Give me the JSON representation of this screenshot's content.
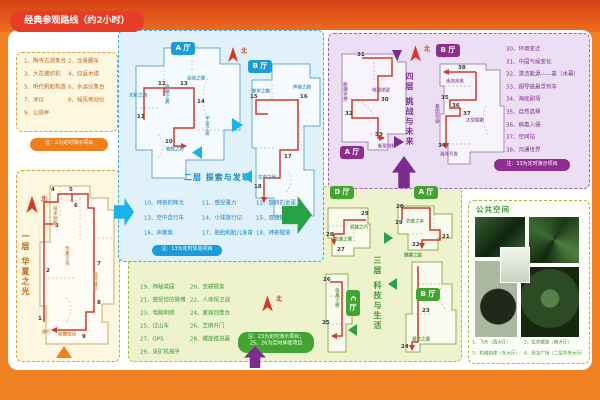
{
  "labels": {
    "north": "北"
  },
  "header": {
    "title": "经典参观路线（约2小时）"
  },
  "colors": {
    "orange": "#f08122",
    "red_route": "#d4382a",
    "floor1": "#c0661d",
    "floor2": "#1b9cd8",
    "floor3": "#43a531",
    "floor4": "#8e2d8e",
    "title_pill": "#e63c28"
  },
  "f1": {
    "floor_title": "一层  华夏之光",
    "list": [
      "1、陶寺古观象台",
      "3、大花楼织机",
      "5、明代帆船构造",
      "7、浑仪",
      "9、公道杯",
      "2、龙骨翻车",
      "4、应县木塔",
      "6、水运仪象台",
      "8、候风地动仪"
    ],
    "note": "注：3为定时演示项目",
    "stops": [
      "1",
      "2",
      "3",
      "4",
      "5",
      "6",
      "7",
      "8",
      "9"
    ],
    "zones": {
      "tech": "技术创新",
      "hall": "华夏之光",
      "temp": "临时展厅",
      "xu": "序厅",
      "rest": "休憩空间"
    }
  },
  "f2": {
    "floor_title": "二层  探索与发现",
    "hall_a": "A 厅",
    "hall_b": "B 厅",
    "zones": {
      "light": "光影之趣",
      "em": "电磁之奥",
      "motion": "运动之律",
      "cosmos": "宇宙之奇",
      "matter": "物质之妙",
      "math": "数学之魅",
      "sound": "声音之韵",
      "life": "生命之秘"
    },
    "stops": [
      "10",
      "11",
      "12",
      "13",
      "14",
      "15",
      "16",
      "17",
      "18"
    ],
    "list": [
      "10、神奇的辉光",
      "11、感受重力",
      "12、旋转的金蛋",
      "13、空中自行车",
      "14、小球旅行记",
      "15、双曲狭缝",
      "16、声聚焦",
      "17、胚胎和胎儿发育",
      "18、神奇隧道"
    ],
    "note": "注：13为定时体验项目"
  },
  "f3": {
    "floor_title": "三层  科技与生活",
    "hall_a": "A 厅",
    "hall_b": "B 厅",
    "hall_c": "C 厅",
    "hall_d": "D 厅",
    "zones": {
      "traffic": "交通之便",
      "mech": "机械之巧",
      "info": "信息之桥",
      "food": "衣食之本",
      "health": "健康之路",
      "home": "居家之道"
    },
    "stops": [
      "19",
      "20",
      "21",
      "22",
      "23",
      "24",
      "25",
      "26",
      "27",
      "28",
      "29"
    ],
    "list": [
      "19、神秘菜园",
      "20、农耕撷英",
      "21、感受您的脉搏",
      "22、人体保卫战",
      "23、电脑刺绣",
      "24、家居创意台",
      "25、过山车",
      "26、芝麻开门",
      "27、GPS",
      "28、螺旋推进器",
      "29、采矿机械手"
    ],
    "note_line1": "注：23为定时演示项目；",
    "note_line2": "25、26为定时体验项目"
  },
  "f4": {
    "floor_title": "四层  挑战与未来",
    "hall_a": "A 厅",
    "hall_b": "B 厅",
    "zones": {
      "energy": "能源世界",
      "earth": "地球述说",
      "material": "新型材料",
      "future": "走向未来",
      "gene": "基因生命",
      "space": "太空探索",
      "ocean": "海洋开发"
    },
    "stops": [
      "30",
      "31",
      "32",
      "33",
      "34",
      "35",
      "36",
      "37",
      "38"
    ],
    "list": [
      "30、环境变迁",
      "31、中国气候变化",
      "32、清洁能源——氢（水幕）",
      "33、超导磁悬浮列车",
      "34、海底剧场",
      "35、自然选择",
      "36、病毒入侵",
      "37、空间站",
      "38、沟通世界"
    ],
    "note": "注：33为定时演示项目"
  },
  "public": {
    "title": "公共空间",
    "captions": [
      "1、飞天（西大厅）",
      "2、生命螺旋（南大厅）",
      "3、机械韵律（东大厅）",
      "4、恐龙广场（二层中央大厅）"
    ]
  }
}
